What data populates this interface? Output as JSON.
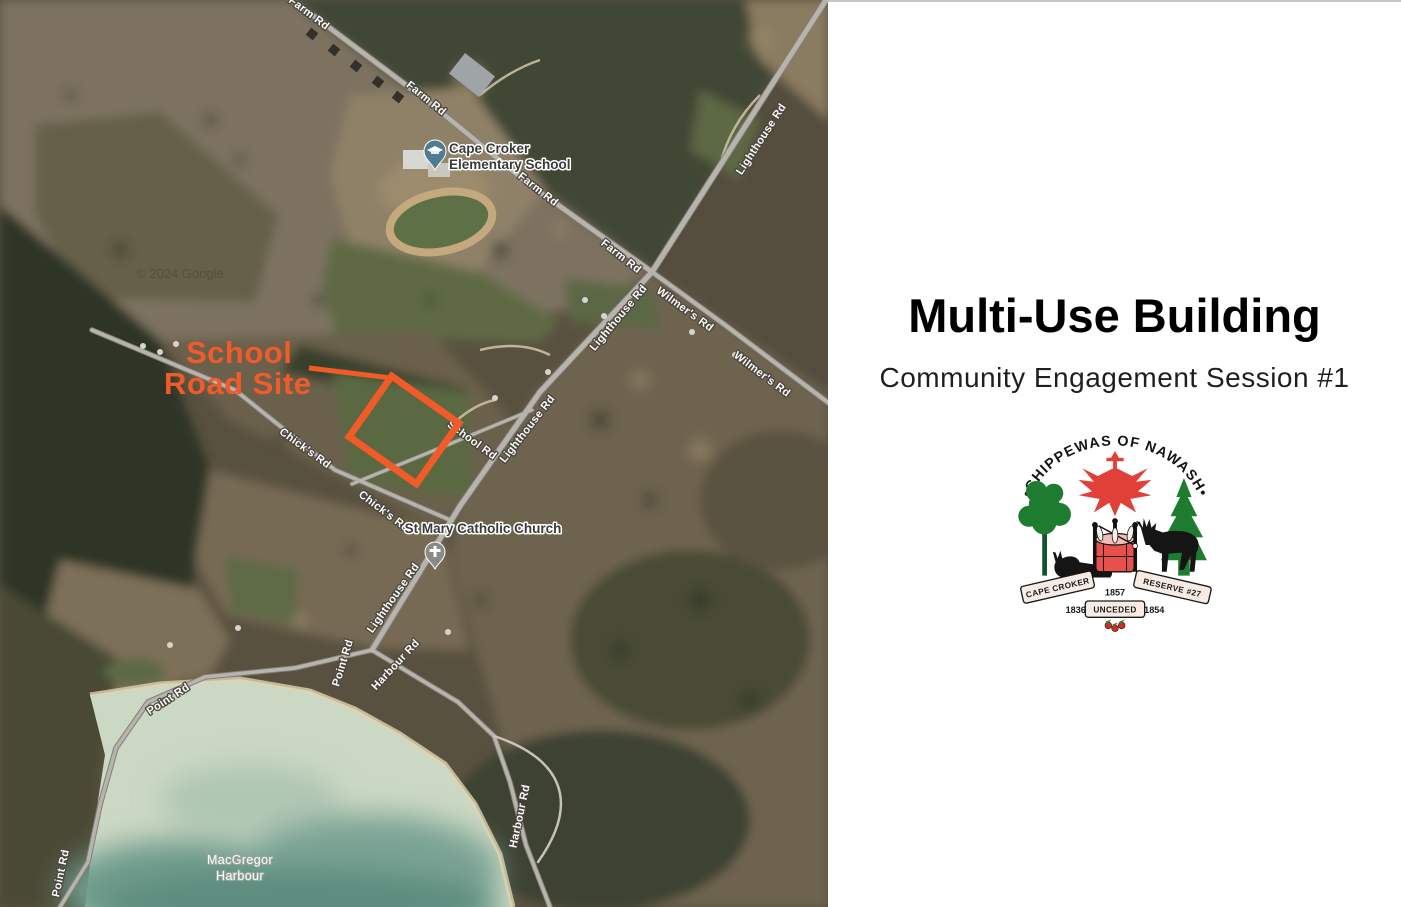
{
  "map": {
    "roads": {
      "farm": "Farm Rd",
      "lighthouse": "Lighthouse Rd",
      "wilmers": "Wilmer's Rd",
      "chicks": "Chick's Rd",
      "school": "School Rd",
      "point": "Point Rd",
      "harbour": "Harbour Rd"
    },
    "pois": {
      "school_line1": "Cape Croker",
      "school_line2": "Elementary School",
      "church": "St Mary Catholic Church"
    },
    "water": {
      "line1": "MacGregor",
      "line2": "Harbour"
    },
    "annotation": {
      "line1": "School",
      "line2": "Road Site",
      "color": "#F15A29"
    },
    "watermark": "© 2024 Google"
  },
  "panel": {
    "title": "Multi-Use Building",
    "subtitle": "Community Engagement Session #1",
    "logo": {
      "arc": "•CHIPPEWAS OF NAWASH•",
      "ribbon_left": "CAPE CROKER",
      "ribbon_right": "RESERVE #27",
      "year_top": "1857",
      "ribbon_center": "UNCEDED",
      "year_left": "1836",
      "year_right": "1854"
    },
    "colors": {
      "accent_orange": "#F15A29",
      "logo_red": "#E0403A",
      "logo_green": "#1E7C31"
    }
  }
}
